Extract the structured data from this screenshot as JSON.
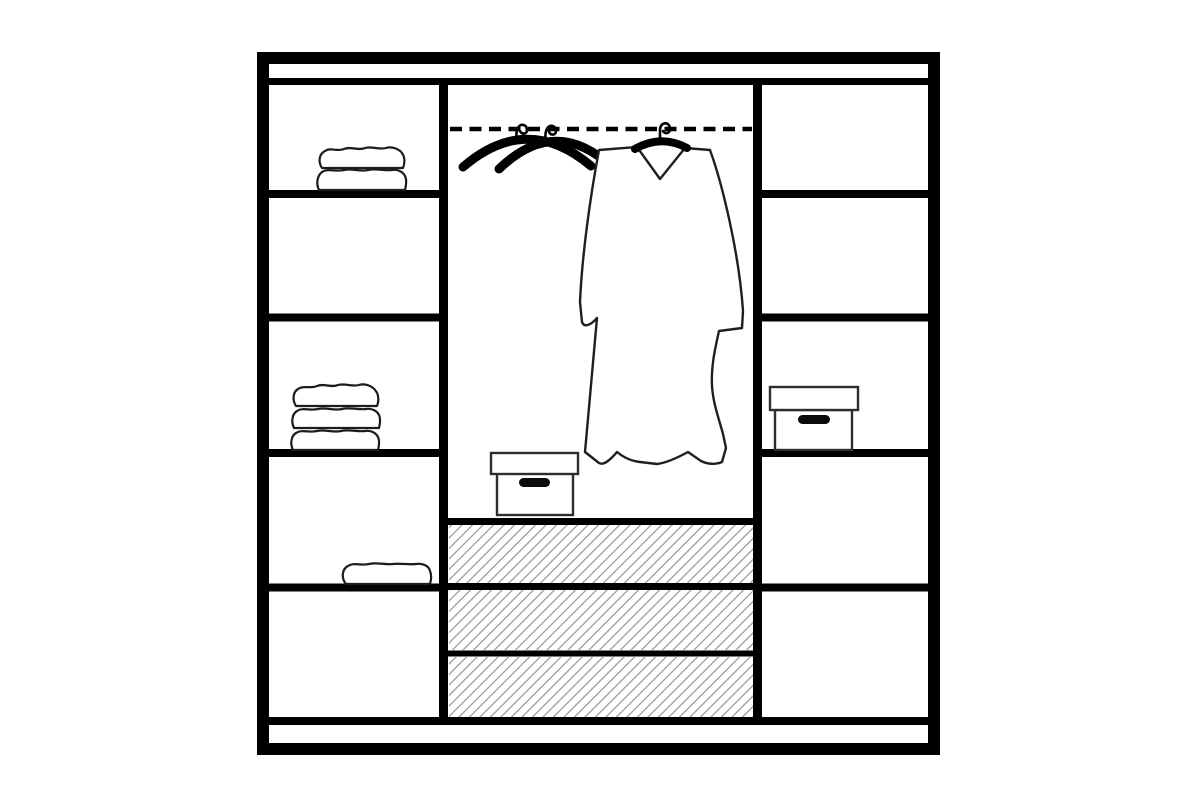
{
  "diagram": {
    "name": "wardrobe-interior-layout-diagram",
    "type": "furniture line drawing",
    "colors": {
      "line": "#000000",
      "soft": "#1f1f1f",
      "box_stroke": "#2e2e2e",
      "towel_stroke": "#1c1c1c",
      "hatch": "#9c9c9c",
      "fill": "#ffffff",
      "handle": "#0b0b0b"
    },
    "structure": {
      "left_column_shelf_cells": 5,
      "right_column_shelf_cells": 5,
      "center_drawers": 3,
      "hanging_rail_style": "dashed",
      "crossed_empty_hangers": 2,
      "garments_on_rail": 1,
      "storage_boxes": 2,
      "towel_stacks": 3,
      "towel_layers_top_stack": 2,
      "towel_layers_middle_stack": 3,
      "towel_layers_lower_stack": 1
    }
  }
}
